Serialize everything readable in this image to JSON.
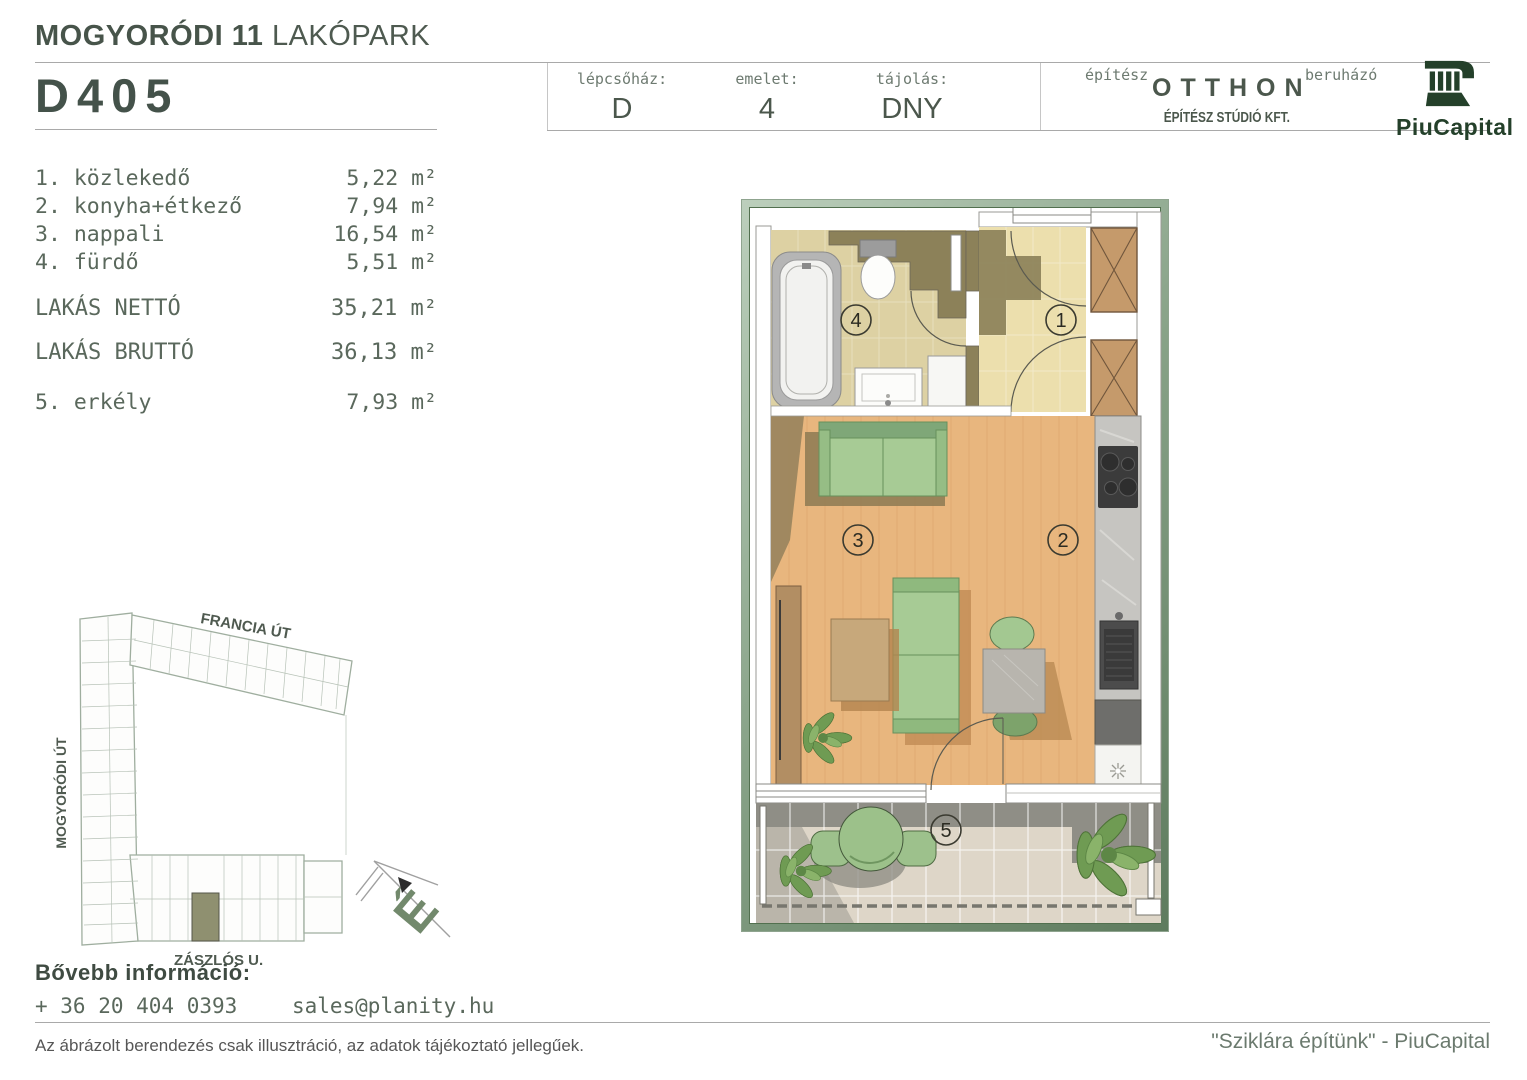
{
  "header": {
    "project_title_bold": "MOGYORÓDI 11",
    "project_title_light": "LAKÓPARK",
    "unit_id": "D405",
    "fields": [
      {
        "label": "lépcsőház:",
        "value": "D"
      },
      {
        "label": "emelet:",
        "value": "4"
      },
      {
        "label": "tájolás:",
        "value": "DNY"
      }
    ],
    "architect_label": "építész",
    "architect_name": "OTTHON",
    "architect_sub": "ÉPÍTÉSZ STÚDIÓ KFT.",
    "developer_label": "beruházó",
    "developer_name": "PiuCapital"
  },
  "rooms": [
    {
      "num": "1.",
      "name": "közlekedő",
      "area": "5,22"
    },
    {
      "num": "2.",
      "name": "konyha+étkező",
      "area": "7,94"
    },
    {
      "num": "3.",
      "name": "nappali",
      "area": "16,54"
    },
    {
      "num": "4.",
      "name": "fürdő",
      "area": "5,51"
    }
  ],
  "totals": [
    {
      "label": "LAKÁS NETTÓ",
      "area": "35,21"
    },
    {
      "label": "LAKÁS BRUTTÓ",
      "area": "36,13"
    }
  ],
  "balcony_row": {
    "num": "5.",
    "name": "erkély",
    "area": "7,93"
  },
  "units": {
    "sqm": "m²"
  },
  "floor_plan": {
    "room_labels": [
      "1",
      "2",
      "3",
      "4",
      "5"
    ]
  },
  "site_plan": {
    "streets": [
      "FRANCIA ÚT",
      "MOGYORÓDI ÚT",
      "ZÁSZLÓS U."
    ],
    "compass_north": "É"
  },
  "contact": {
    "heading": "Bővebb információ:",
    "phone": "+ 36 20 404 0393",
    "email": "sales@planity.hu"
  },
  "footer": {
    "disclaimer": "Az ábrázolt berendezés csak illusztráció, az adatok tájékoztató jellegűek.",
    "slogan": "\"Sziklára építünk\" - PiuCapital"
  },
  "colors": {
    "accent_text": "#4b574c",
    "brand_green": "#24402a",
    "frame_green": "#7d977d",
    "wood_floor": "#e8b67e",
    "bath_floor": "#ddd1a3",
    "hall_floor": "#ecdfad"
  }
}
